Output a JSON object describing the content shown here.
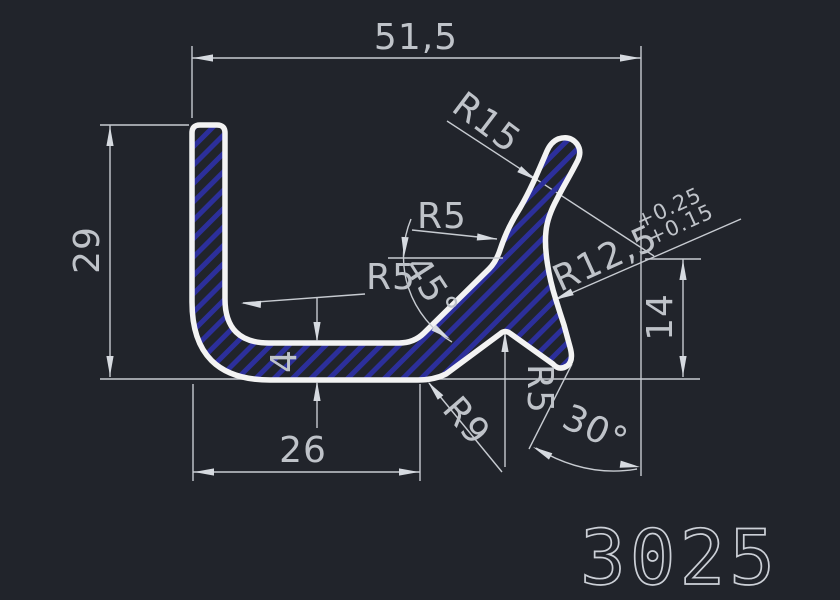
{
  "part_label": "3025",
  "dims": {
    "width_total": "51,5",
    "height_left": "29",
    "width_base": "26",
    "thickness": "4",
    "height_right": "14",
    "angle_strut": "45°",
    "angle_foot": "30°",
    "r_leg_inner": "R5",
    "r_fork": "R5",
    "r_notch": "R5",
    "r_arm_outer": "R15",
    "r_base_outer": "R9",
    "r_concave": "R12,5",
    "tol_plus_upper": "+0.25",
    "tol_plus_lower": "+0.15"
  },
  "colors": {
    "background": "#21242b",
    "annotation": "#c7cbd1",
    "profile_outline": "#f3f3f3",
    "hatch_blue": "#2c2f9b",
    "text": "#bfc3c9"
  }
}
